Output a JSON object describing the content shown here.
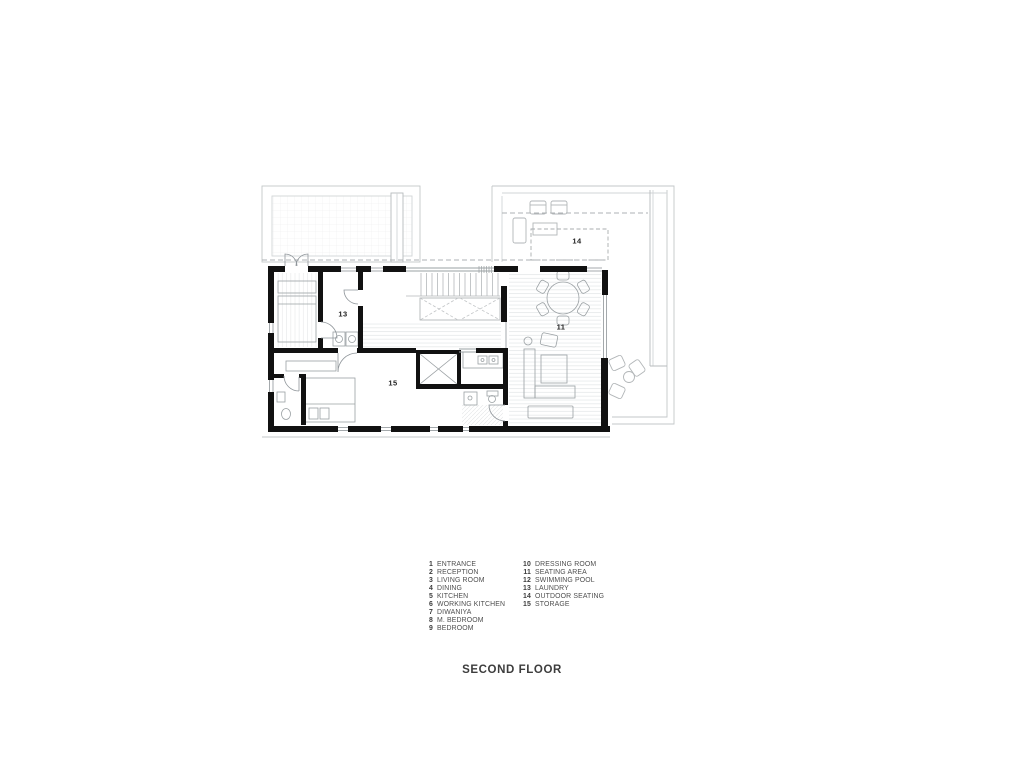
{
  "title": "SECOND FLOOR",
  "legend": {
    "col1": [
      {
        "num": "1",
        "label": "ENTRANCE"
      },
      {
        "num": "2",
        "label": "RECEPTION"
      },
      {
        "num": "3",
        "label": "LIVING ROOM"
      },
      {
        "num": "4",
        "label": "DINING"
      },
      {
        "num": "5",
        "label": "KITCHEN"
      },
      {
        "num": "6",
        "label": "WORKING KITCHEN"
      },
      {
        "num": "7",
        "label": "DIWANIYA"
      },
      {
        "num": "8",
        "label": "M. BEDROOM"
      },
      {
        "num": "9",
        "label": "BEDROOM"
      }
    ],
    "col2": [
      {
        "num": "10",
        "label": "DRESSING ROOM"
      },
      {
        "num": "11",
        "label": "SEATING AREA"
      },
      {
        "num": "12",
        "label": "SWIMMING POOL"
      },
      {
        "num": "13",
        "label": "LAUNDRY"
      },
      {
        "num": "14",
        "label": "OUTDOOR SEATING"
      },
      {
        "num": "15",
        "label": "STORAGE"
      }
    ]
  },
  "plan": {
    "labels": [
      {
        "text": "13"
      },
      {
        "text": "15"
      },
      {
        "text": "11"
      },
      {
        "text": "14"
      }
    ]
  },
  "colors": {
    "wall": "#111111",
    "thin_line": "#9aa0a3",
    "terrace_line": "#c3c7c9",
    "hatch": "#e3e5e7",
    "dashed": "#aeb2b4",
    "text": "#4f4f4f"
  }
}
